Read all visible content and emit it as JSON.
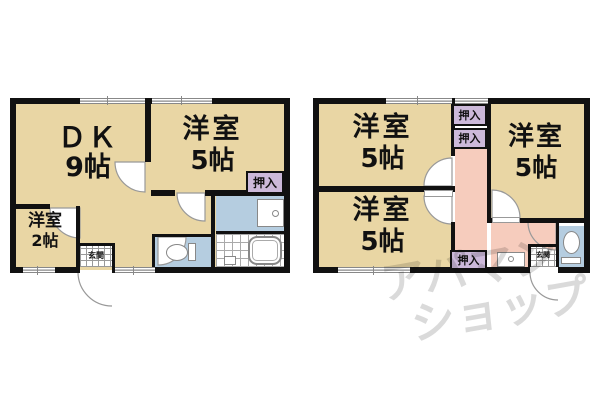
{
  "floor_left": {
    "rooms": [
      {
        "name": "ＤＫ",
        "size": "9帖"
      },
      {
        "name": "洋室",
        "size": "5帖"
      },
      {
        "name": "洋室",
        "size": "2帖"
      }
    ],
    "closets": [
      "押入"
    ],
    "entrance": "玄関"
  },
  "floor_right": {
    "rooms": [
      {
        "name": "洋室",
        "size": "5帖"
      },
      {
        "name": "洋室",
        "size": "5帖"
      },
      {
        "name": "洋室",
        "size": "5帖"
      }
    ],
    "closets": [
      "押入",
      "押入",
      "押入"
    ],
    "entrance": "玄関"
  },
  "watermark": {
    "line1": "アパマン",
    "line2": "ショップ"
  },
  "colors": {
    "room_tan": "#e9d6a4",
    "closet_purple": "#ccb9da",
    "hall_pink": "#f6ccbd",
    "wet_blue": "#b5cde0",
    "wall_black": "#111111",
    "watermark_gray": "#c9c9c9"
  }
}
